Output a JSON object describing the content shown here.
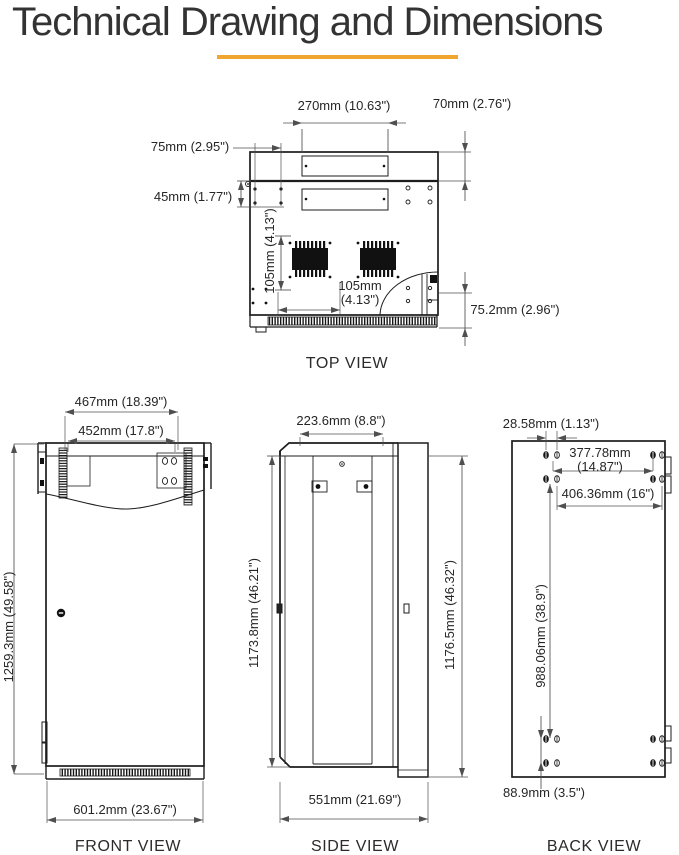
{
  "page": {
    "title": "Technical Drawing and Dimensions"
  },
  "accent_color": "#F0A62E",
  "views": {
    "top": {
      "label": "TOP VIEW",
      "dims": {
        "d270": "270mm (10.63\")",
        "d70": "70mm (2.76\")",
        "d75": "75mm (2.95\")",
        "d45": "45mm (1.77\")",
        "d105v": "105mm (4.13\")",
        "d105h_line1": "105mm",
        "d105h_line2": "(4.13\")",
        "d752": "75.2mm (2.96\")"
      }
    },
    "front": {
      "label": "FRONT VIEW",
      "dims": {
        "d467": "467mm (18.39\")",
        "d452": "452mm (17.8\")",
        "d1259": "1259.3mm (49.58\")",
        "d601": "601.2mm (23.67\")"
      }
    },
    "side": {
      "label": "SIDE VIEW",
      "dims": {
        "d223": "223.6mm (8.8\")",
        "d1173": "1173.8mm (46.21\")",
        "d1176": "1176.5mm (46.32\")",
        "d551": "551mm (21.69\")"
      }
    },
    "back": {
      "label": "BACK VIEW",
      "dims": {
        "d2858": "28.58mm (1.13\")",
        "d377_line1": "377.78mm",
        "d377_line2": "(14.87\")",
        "d406": "406.36mm (16\")",
        "d988": "988.06mm (38.9\")",
        "d889": "88.9mm (3.5\")"
      }
    }
  }
}
